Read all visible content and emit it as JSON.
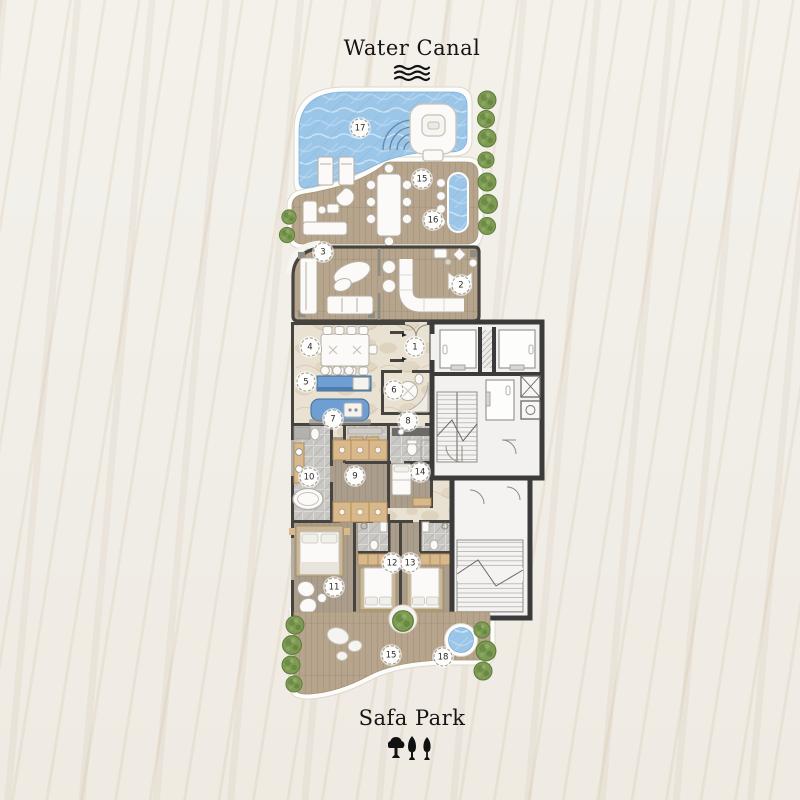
{
  "page": {
    "top_area_label": "Water Canal",
    "bottom_area_label": "Safa Park"
  },
  "icons": {
    "top": "water-waves-icon",
    "bottom": "park-trees-icon"
  },
  "badges": [
    {
      "num": "1",
      "room": "entrance-foyer"
    },
    {
      "num": "2",
      "room": "living-room"
    },
    {
      "num": "3",
      "room": "terrace-lounge"
    },
    {
      "num": "4",
      "room": "dining-area"
    },
    {
      "num": "5",
      "room": "kitchen-breakfast-bar"
    },
    {
      "num": "6",
      "room": "powder-room"
    },
    {
      "num": "7",
      "room": "kitchen-island"
    },
    {
      "num": "8",
      "room": "laundry-room"
    },
    {
      "num": "9",
      "room": "walk-in-closet"
    },
    {
      "num": "10",
      "room": "master-bathroom"
    },
    {
      "num": "11",
      "room": "master-bedroom"
    },
    {
      "num": "12",
      "room": "bedroom-2"
    },
    {
      "num": "13",
      "room": "bedroom-3"
    },
    {
      "num": "14",
      "room": "maid-room"
    },
    {
      "num": "15",
      "room": "upper-terrace-deck"
    },
    {
      "num": "16",
      "room": "water-feature"
    },
    {
      "num": "17",
      "room": "swimming-pool"
    },
    {
      "num": "15",
      "room": "lower-terrace-deck"
    },
    {
      "num": "18",
      "room": "plunge-pool"
    }
  ],
  "colors": {
    "background": "#f1eee8",
    "ink": "#161514",
    "wall": "#474440",
    "core_wall": "#3b3b3b",
    "deck": "#b6a58c",
    "pool": "#9cc6e8",
    "marble": "#e9e1d2",
    "bedroom_floor": "#aa9d8c",
    "tile": "#c9c7c4",
    "counter": "#6f9fd2",
    "cabinet": "#d9b98c",
    "furniture": "#fbfaf8",
    "furniture_edge": "#b5afa5",
    "tree": "#7d9b52",
    "badge_border": "#9a948b"
  }
}
